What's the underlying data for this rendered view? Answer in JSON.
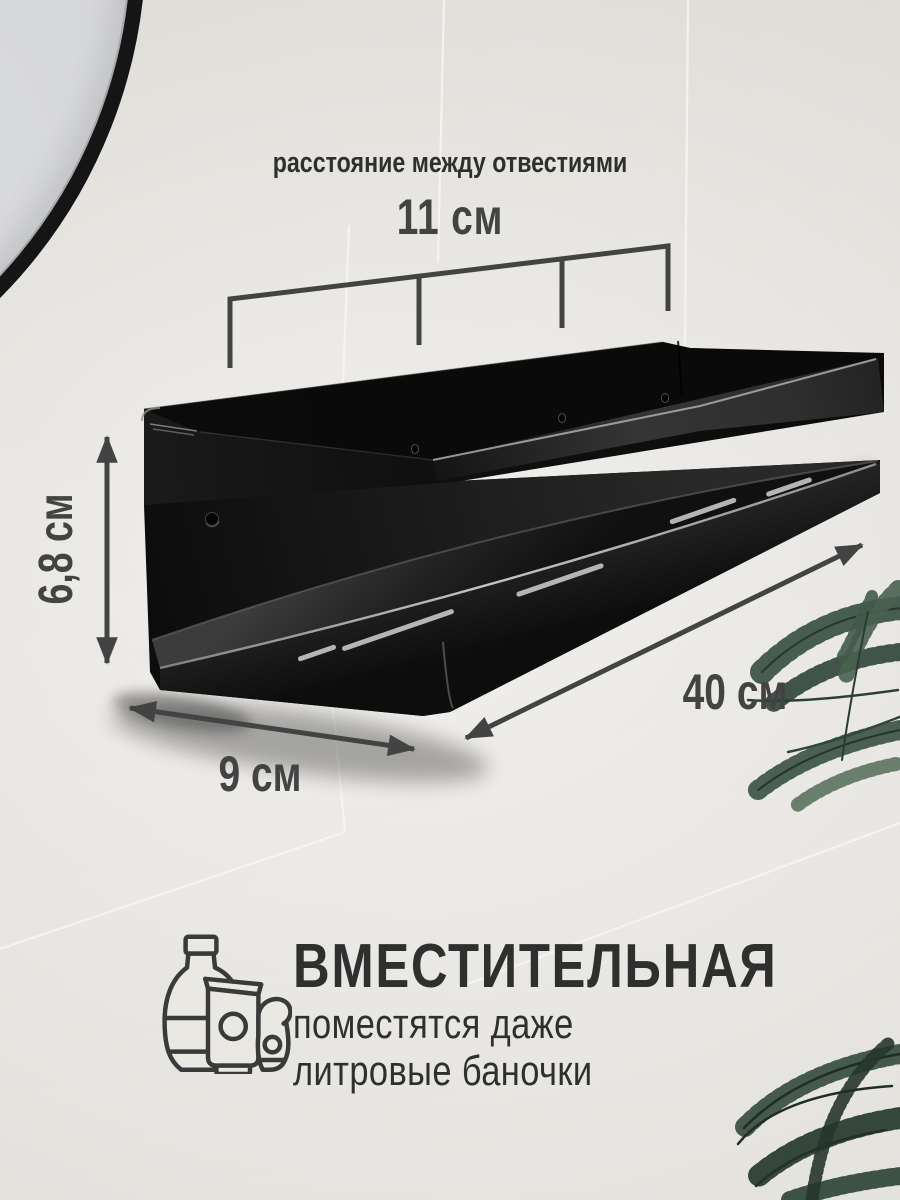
{
  "image_kind": "product-infographic-photo",
  "product": "black metal wall shelf, two tiers, mounted on light tiled bathroom wall",
  "product_labels": {
    "holes_caption": "расстояние между отвестиями",
    "holes_distance": "11 см",
    "height": "6,8 см",
    "depth": "9 см",
    "width": "40 см"
  },
  "feature": {
    "title": "ВМЕСТИТЕЛЬНАЯ",
    "line1": "поместятся даже",
    "line2": "литровые баночки"
  },
  "icons": {
    "feature_icon": "cosmetics-bottles-icon",
    "dimension_markers": [
      "double-arrow-icon",
      "bracket-ruler-icon"
    ]
  },
  "scene_objects": [
    "round-mirror (top-left, partial)",
    "wall-shelf",
    "palm-plant (right)"
  ],
  "colors": {
    "wall": "#eae8e3",
    "shelf": "#0d0d0d",
    "dimension": "#434343",
    "text": "#2f2f2f",
    "grout": "#f8f7f3",
    "plant": "#3d5446",
    "mirror_frame": "#151515"
  }
}
